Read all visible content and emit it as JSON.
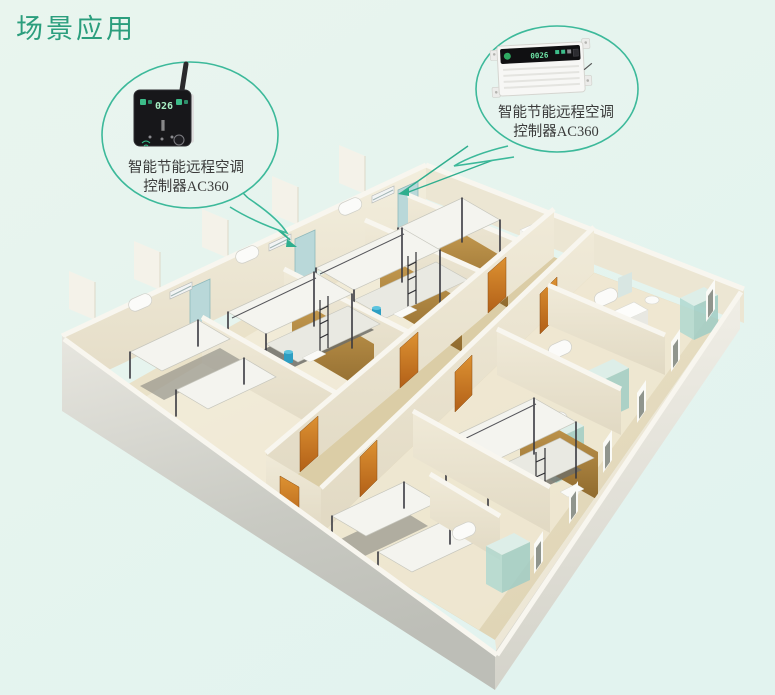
{
  "page": {
    "title": "场景应用"
  },
  "colors": {
    "accent": "#2fae8e",
    "title": "#2b9e7d",
    "label": "#3b3b3b",
    "background": "#e7f4ee"
  },
  "callouts": {
    "left": {
      "line1": "智能节能远程空调",
      "line2": "控制器AC360",
      "display": "026"
    },
    "right": {
      "line1": "智能节能远程空调",
      "line2": "控制器AC360",
      "display": "0026"
    }
  }
}
